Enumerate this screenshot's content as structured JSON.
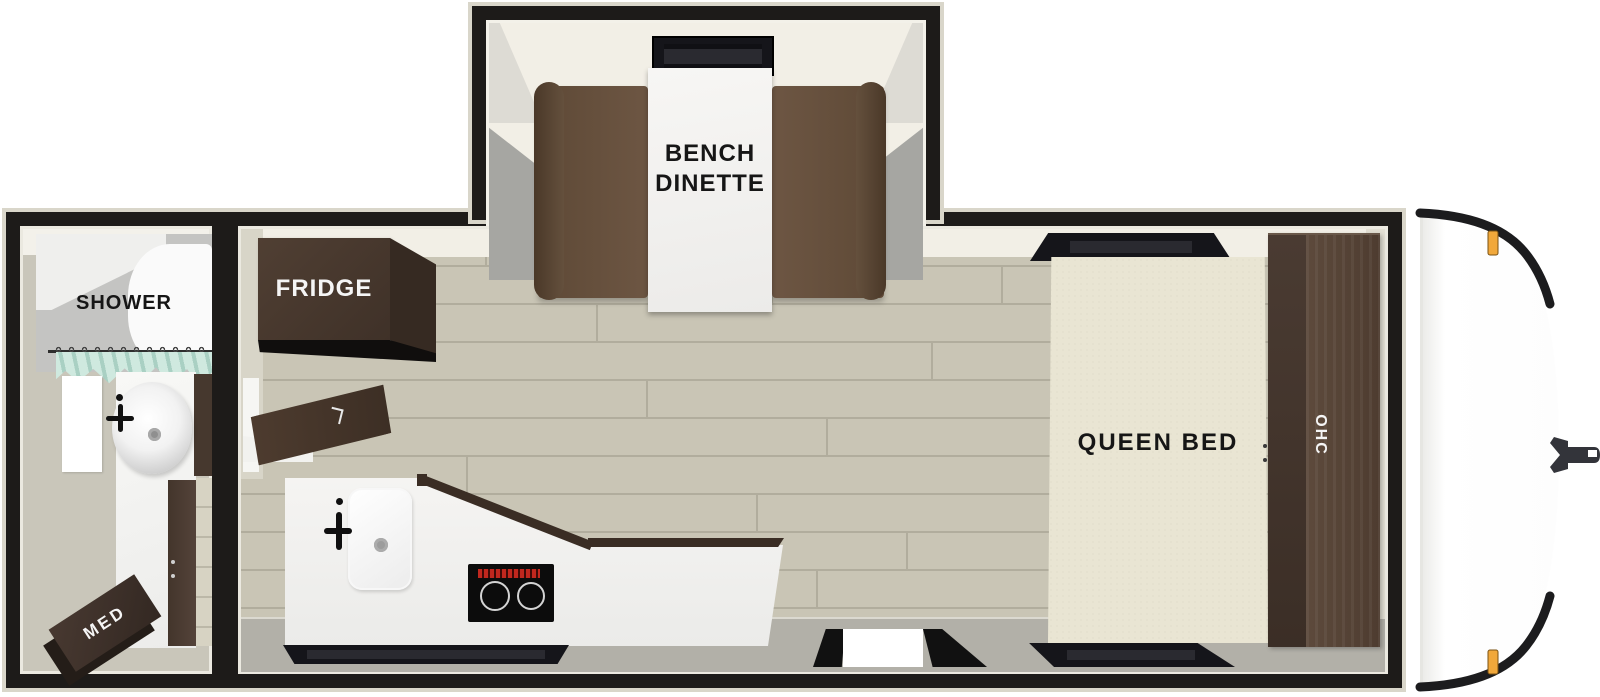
{
  "floorplan": {
    "type": "travel-trailer-floorplan",
    "areas": {
      "bathroom": {
        "shower_label": "SHOWER",
        "med_cabinet_label": "MED"
      },
      "kitchen": {
        "fridge_label": "FRIDGE"
      },
      "dinette": {
        "label_line1": "BENCH",
        "label_line2": "DINETTE"
      },
      "bedroom": {
        "bed_label": "QUEEN BED",
        "overhead_cabinet_label": "OHC"
      }
    },
    "colors": {
      "wall": "#1d1b19",
      "wall_outline": "#d9d6ca",
      "wall_cream": "#f2efe6",
      "floor_wood": "#c9c5b5",
      "floor_plank_line": "#b1ad9d",
      "floor_gray": "#b2b0a8",
      "bath_floor": "#c9c6ba",
      "cabinet_dark": "#46382e",
      "bench_brown": "#6b5440",
      "bed_cream": "#e9e5d3",
      "counter_white": "#f4f3f1",
      "curtain_teal": "#cfe9df",
      "marker_light": "#f1a83b",
      "cooktop_black": "#0c0c0c",
      "cooktop_display_red": "#c0271e"
    }
  }
}
